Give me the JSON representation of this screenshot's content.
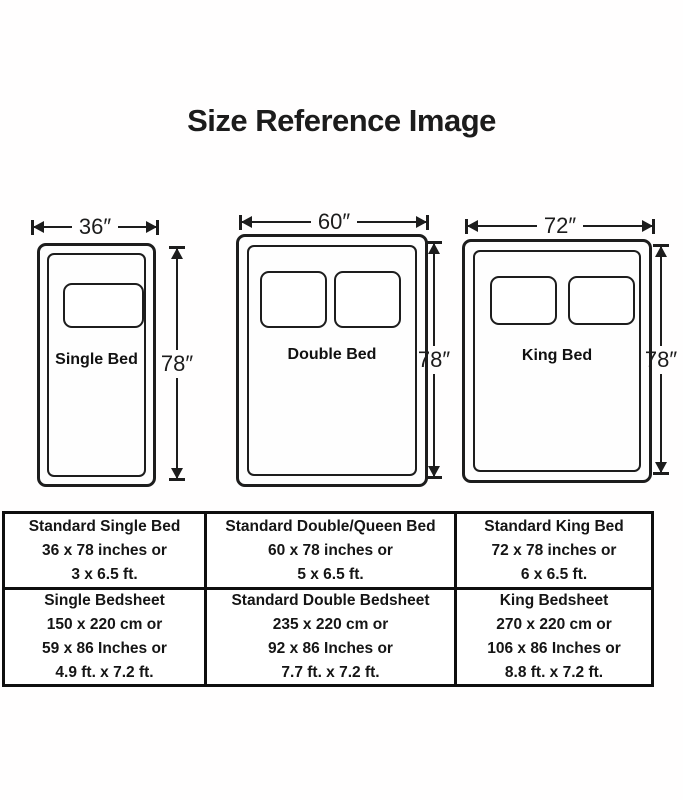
{
  "title": "Size Reference Image",
  "beds": [
    {
      "name": "Single Bed",
      "width_label": "36″",
      "height_label": "78″"
    },
    {
      "name": "Double Bed",
      "width_label": "60″",
      "height_label": "78″"
    },
    {
      "name": "King Bed",
      "width_label": "72″",
      "height_label": "78″"
    }
  ],
  "table": {
    "rows": [
      [
        {
          "lines": [
            "Standard Single Bed",
            "36 x 78 inches or",
            "3 x 6.5 ft."
          ]
        },
        {
          "lines": [
            "Standard Double/Queen Bed",
            "60 x 78 inches or",
            "5 x 6.5 ft."
          ]
        },
        {
          "lines": [
            "Standard King Bed",
            "72 x 78 inches or",
            "6 x 6.5 ft."
          ]
        }
      ],
      [
        {
          "lines": [
            "Single Bedsheet",
            "150 x 220 cm or",
            "59 x 86 Inches or",
            "4.9 ft. x 7.2 ft."
          ]
        },
        {
          "lines": [
            "Standard Double Bedsheet",
            "235 x 220 cm or",
            "92 x 86 Inches or",
            "7.7 ft. x 7.2 ft."
          ]
        },
        {
          "lines": [
            "King Bedsheet",
            "270 x 220 cm or",
            "106 x 86 Inches or",
            "8.8 ft. x 7.2 ft."
          ]
        }
      ]
    ]
  },
  "colors": {
    "line": "#1d1d1d",
    "background": "#ffffff"
  }
}
